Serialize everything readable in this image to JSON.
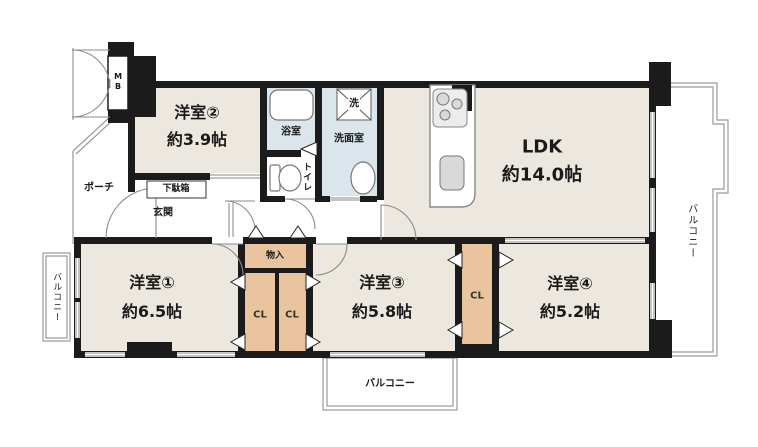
{
  "rooms": {
    "room1": {
      "name": "洋室①",
      "size": "約6.5帖"
    },
    "room2": {
      "name": "洋室②",
      "size": "約3.9帖"
    },
    "room3": {
      "name": "洋室③",
      "size": "約5.8帖"
    },
    "room4": {
      "name": "洋室④",
      "size": "約5.2帖"
    },
    "ldk": {
      "name": "LDK",
      "size": "約14.0帖"
    }
  },
  "labels": {
    "bathroom": "浴室",
    "washroom": "洗面室",
    "toilet": "トイレ",
    "washer": "洗",
    "entrance": "玄関",
    "porch": "ポーチ",
    "shoe_cabinet": "下駄箱",
    "storage": "物入",
    "closet": "CL",
    "meter_box": "MB",
    "balcony": "バルコニー"
  },
  "colors": {
    "background": "#ffffff",
    "room_fill": "#ece8df",
    "wet_fill": "#dae5ec",
    "closet_fill": "#eac49f",
    "wall": "#1b1b1b",
    "outline": "#999999"
  }
}
